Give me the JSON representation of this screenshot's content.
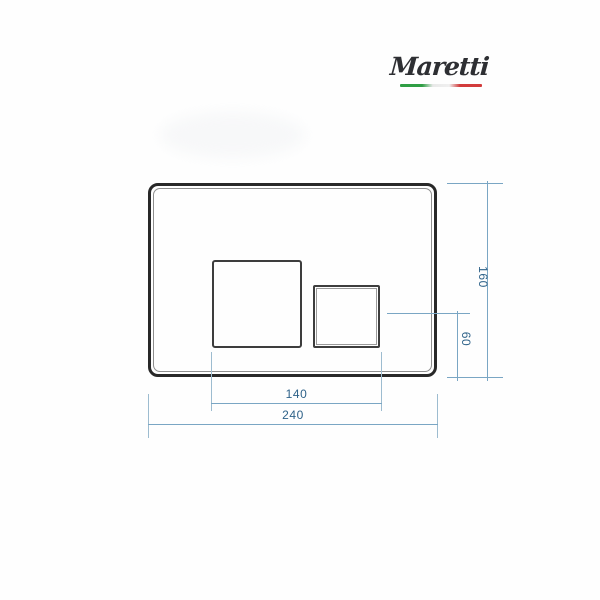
{
  "logo": {
    "brand": "Maretti",
    "flag_colors": {
      "green": "#2f9e44",
      "white": "#e9e9e9",
      "red": "#d23b3b"
    }
  },
  "drawing": {
    "type": "technical-dimension-diagram",
    "subject": "toilet flush plate with two rectangular buttons",
    "dimensions": {
      "plate_height": {
        "label": "160"
      },
      "small_button_height": {
        "label": "60"
      },
      "buttons_span_width": {
        "label": "140"
      },
      "plate_width": {
        "label": "240"
      }
    },
    "colors": {
      "plate_border": "#282828",
      "plate_inner_line": "#8e8e8e",
      "button_border": "#3d3d3d",
      "dimension_line": "#7aa6c4",
      "dimension_text": "#2e6289",
      "background": "#fefefe"
    }
  }
}
